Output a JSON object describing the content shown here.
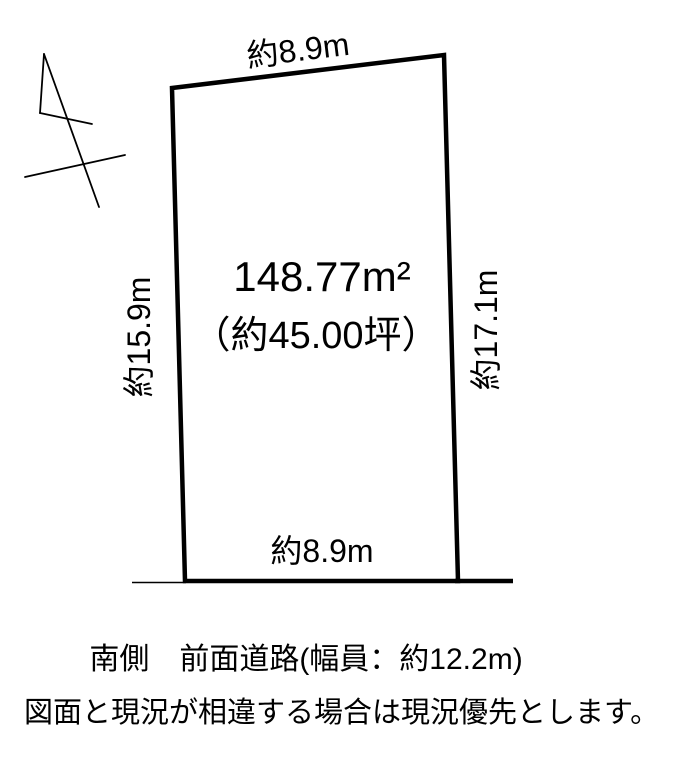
{
  "page": {
    "background": "#ffffff",
    "line_color": "#000000",
    "text_color": "#000000"
  },
  "plot": {
    "area_m2": "148.77m²",
    "area_tsubo": "（約45.00坪）",
    "dimensions": {
      "top": "約8.9m",
      "bottom": "約8.9m",
      "left": "約15.9m",
      "right": "約17.1m"
    }
  },
  "notes": {
    "road": "南側　前面道路(幅員：約12.2m)",
    "disclaimer": "図面と現況が相違する場合は現況優先とします。"
  },
  "icons": {
    "north_arrow": "north-arrow"
  }
}
